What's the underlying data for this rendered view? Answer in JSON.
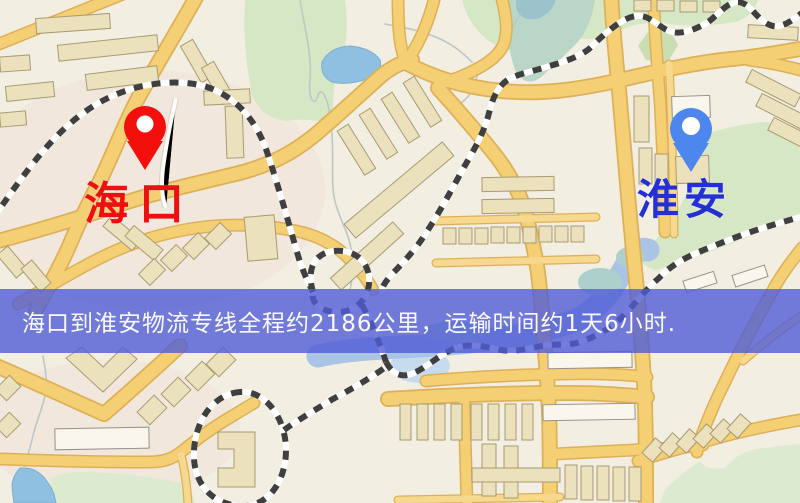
{
  "map": {
    "origin": {
      "name": "海口",
      "pin_icon": "origin-pin-icon",
      "pin_color": "#f20f0c",
      "label_color": "#ee1010"
    },
    "destination": {
      "name": "淮安",
      "pin_icon": "destination-pin-icon",
      "pin_color": "#4d87ee",
      "label_color": "#2430d6"
    },
    "banner": {
      "text": "海口到淮安物流专线全程约2186公里，运输时间约1天6小时.",
      "bg_color": "rgba(80,92,214,0.8)",
      "text_color": "#ffffff"
    },
    "distance_km": "2186",
    "duration": "1天6小时",
    "map_colors": {
      "road": "#f5cf74",
      "water": "#8fc0e2",
      "park": "#d5e7c4",
      "railway": "#3f3f3f",
      "building": "#ebe1bd"
    }
  }
}
